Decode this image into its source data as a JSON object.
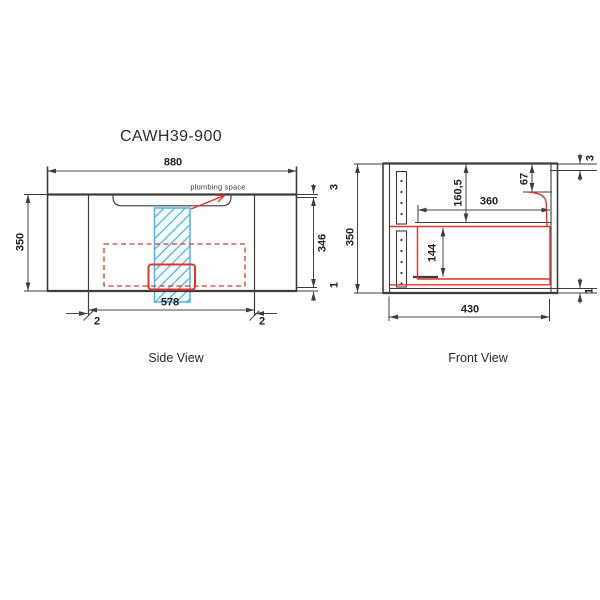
{
  "title": "CAWH39-900",
  "colors": {
    "line": "#3c3c3c",
    "dimension": "#444444",
    "red_overlay": "#e8312a",
    "blue_hatch": "#4ab5e3",
    "text": "#222222"
  },
  "side_view": {
    "caption": "Side View",
    "annotation": "plumbing space",
    "dims": {
      "overall_width": "880",
      "overall_height": "350",
      "inner_width": "578",
      "left_panel_gap": "2",
      "right_panel_gap": "2",
      "top_thickness": "3",
      "inner_height": "346",
      "bottom_gap": "1"
    }
  },
  "front_view": {
    "caption": "Front View",
    "dims": {
      "overall_height": "350",
      "top_gap": "3",
      "top_section_height": "67",
      "upper_section_height": "160,5",
      "opening_width": "360",
      "drawer_height": "144",
      "bottom_gap": "1",
      "bottom_width": "430"
    }
  }
}
